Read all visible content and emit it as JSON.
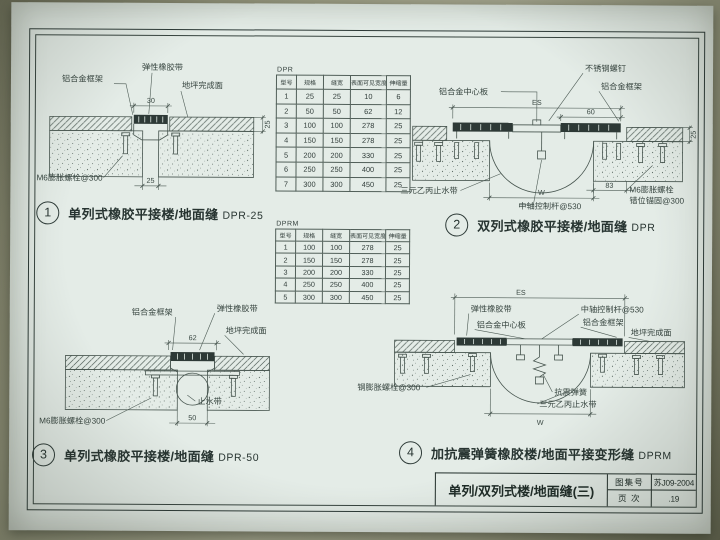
{
  "captions": [
    {
      "num": "1",
      "text": "单列式橡胶平接楼/地面缝",
      "code": "DPR-25"
    },
    {
      "num": "2",
      "text": "双列式橡胶平接楼/地面缝",
      "code": "DPR"
    },
    {
      "num": "3",
      "text": "单列式橡胶平接楼/地面缝",
      "code": "DPR-50"
    },
    {
      "num": "4",
      "text": "加抗震弹簧橡胶楼/地面平接变形缝",
      "code": "DPRM"
    }
  ],
  "detail1": {
    "labels": {
      "rubber": "弹性橡胶带",
      "frame": "铝合金框架",
      "finish": "地坪完成面",
      "bolt": "M6膨胀螺栓@300"
    },
    "dims": {
      "top": "30",
      "right": "25",
      "bottom": "25"
    }
  },
  "detail2": {
    "labels": {
      "screw": "不锈钢螺钉",
      "center_plate": "铝合金中心板",
      "frame": "铝合金框架",
      "rubber": "弹性橡胶带",
      "finish": "地坪完成面",
      "waterstop": "三元乙丙止水带",
      "rod": "中轴控制杆@530",
      "bolt_line1": "M6膨胀螺栓",
      "bolt_line2": "错位锚固@300"
    },
    "dims": {
      "es": "ES",
      "sixty": "60",
      "right": "25",
      "eighty_three": "83",
      "w": "W"
    }
  },
  "detail3": {
    "labels": {
      "frame": "铝合金框架",
      "rubber": "弹性橡胶带",
      "finish": "地坪完成面",
      "waterstop": "止水带",
      "bolt": "M6膨胀螺栓@300"
    },
    "dims": {
      "top": "62",
      "bottom": "50"
    }
  },
  "detail4": {
    "labels": {
      "rubber": "弹性橡胶带",
      "center_plate": "铝合金中心板",
      "rod": "中轴控制杆@530",
      "frame": "铝合金框架",
      "finish": "地坪完成面",
      "bolt": "钢膨胀螺栓@300",
      "spring": "抗震弹簧",
      "waterstop": "三元乙丙止水带"
    },
    "dims": {
      "es": "ES",
      "w": "W"
    }
  },
  "tables": {
    "dpr": {
      "label": "DPR",
      "headers": [
        "型号",
        "规格",
        "缝宽",
        "表面可见宽度",
        "伸缩量"
      ],
      "rows": [
        [
          "1",
          "25",
          "25",
          "10",
          "6"
        ],
        [
          "2",
          "50",
          "50",
          "62",
          "12"
        ],
        [
          "3",
          "100",
          "100",
          "278",
          "25"
        ],
        [
          "4",
          "150",
          "150",
          "278",
          "25"
        ],
        [
          "5",
          "200",
          "200",
          "330",
          "25"
        ],
        [
          "6",
          "250",
          "250",
          "400",
          "25"
        ],
        [
          "7",
          "300",
          "300",
          "450",
          "25"
        ]
      ]
    },
    "dprm": {
      "label": "DPRM",
      "headers": [
        "型号",
        "规格",
        "缝宽",
        "表面可见宽度",
        "伸缩量"
      ],
      "rows": [
        [
          "1",
          "100",
          "100",
          "278",
          "25"
        ],
        [
          "2",
          "150",
          "150",
          "278",
          "25"
        ],
        [
          "3",
          "200",
          "200",
          "330",
          "25"
        ],
        [
          "4",
          "250",
          "250",
          "400",
          "25"
        ],
        [
          "5",
          "300",
          "300",
          "450",
          "25"
        ]
      ]
    }
  },
  "titleblock": {
    "title": "单列/双列式楼/地面缝(三)",
    "atlas_label": "图集号",
    "atlas_value": "苏J09-2004",
    "page_label": "页 次",
    "page_value": ".19"
  }
}
